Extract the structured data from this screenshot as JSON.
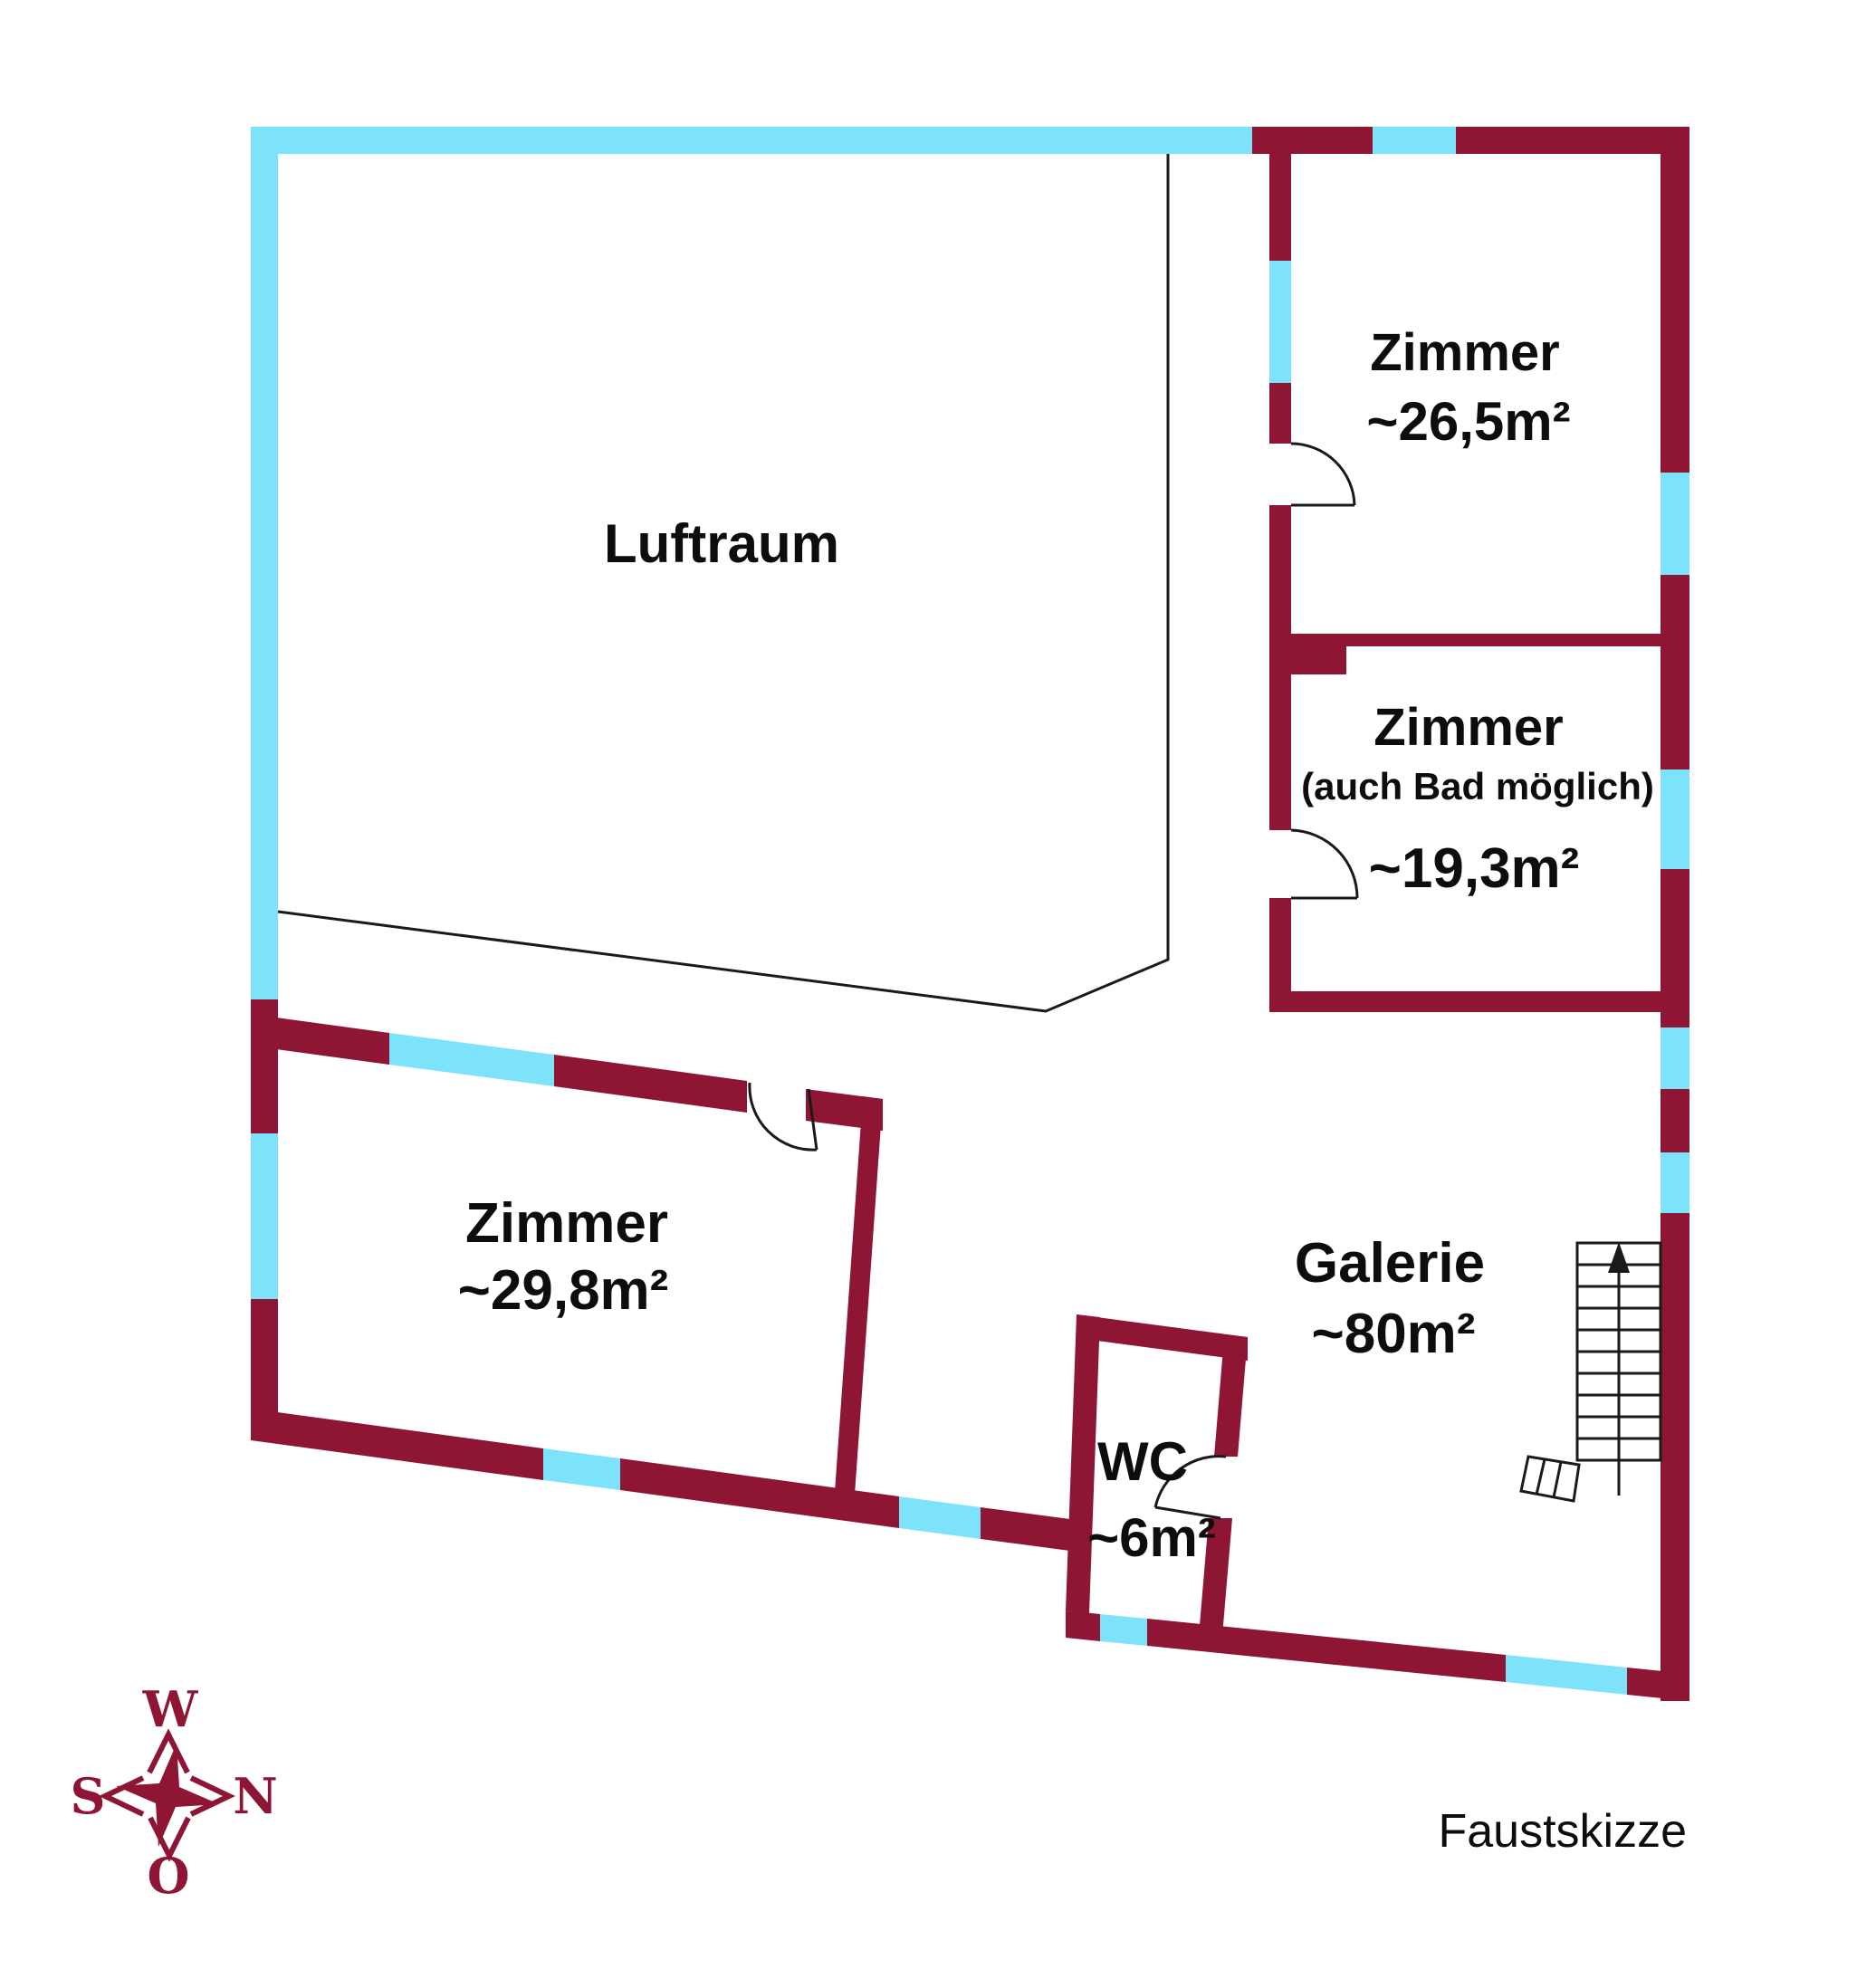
{
  "title": "Faustskizze",
  "colors": {
    "wall": "#8E1533",
    "window": "#7DE3FB",
    "line": "#1A1A1A",
    "text": "#0D0D0D"
  },
  "rooms": {
    "luftraum": {
      "name": "Luftraum"
    },
    "zimmer_nordost": {
      "name": "Zimmer",
      "area": "~26,5m²"
    },
    "zimmer_bad": {
      "name": "Zimmer",
      "note": "(auch Bad möglich)",
      "area": "~19,3m²"
    },
    "zimmer_west": {
      "name": "Zimmer",
      "area": "~29,8m²"
    },
    "galerie": {
      "name": "Galerie",
      "area": "~80m²"
    },
    "wc": {
      "name": "WC",
      "area": "~6m²"
    }
  },
  "compass": {
    "top": "W",
    "left": "S",
    "right": "N",
    "bottom": "O"
  },
  "caption": "Faustskizze"
}
